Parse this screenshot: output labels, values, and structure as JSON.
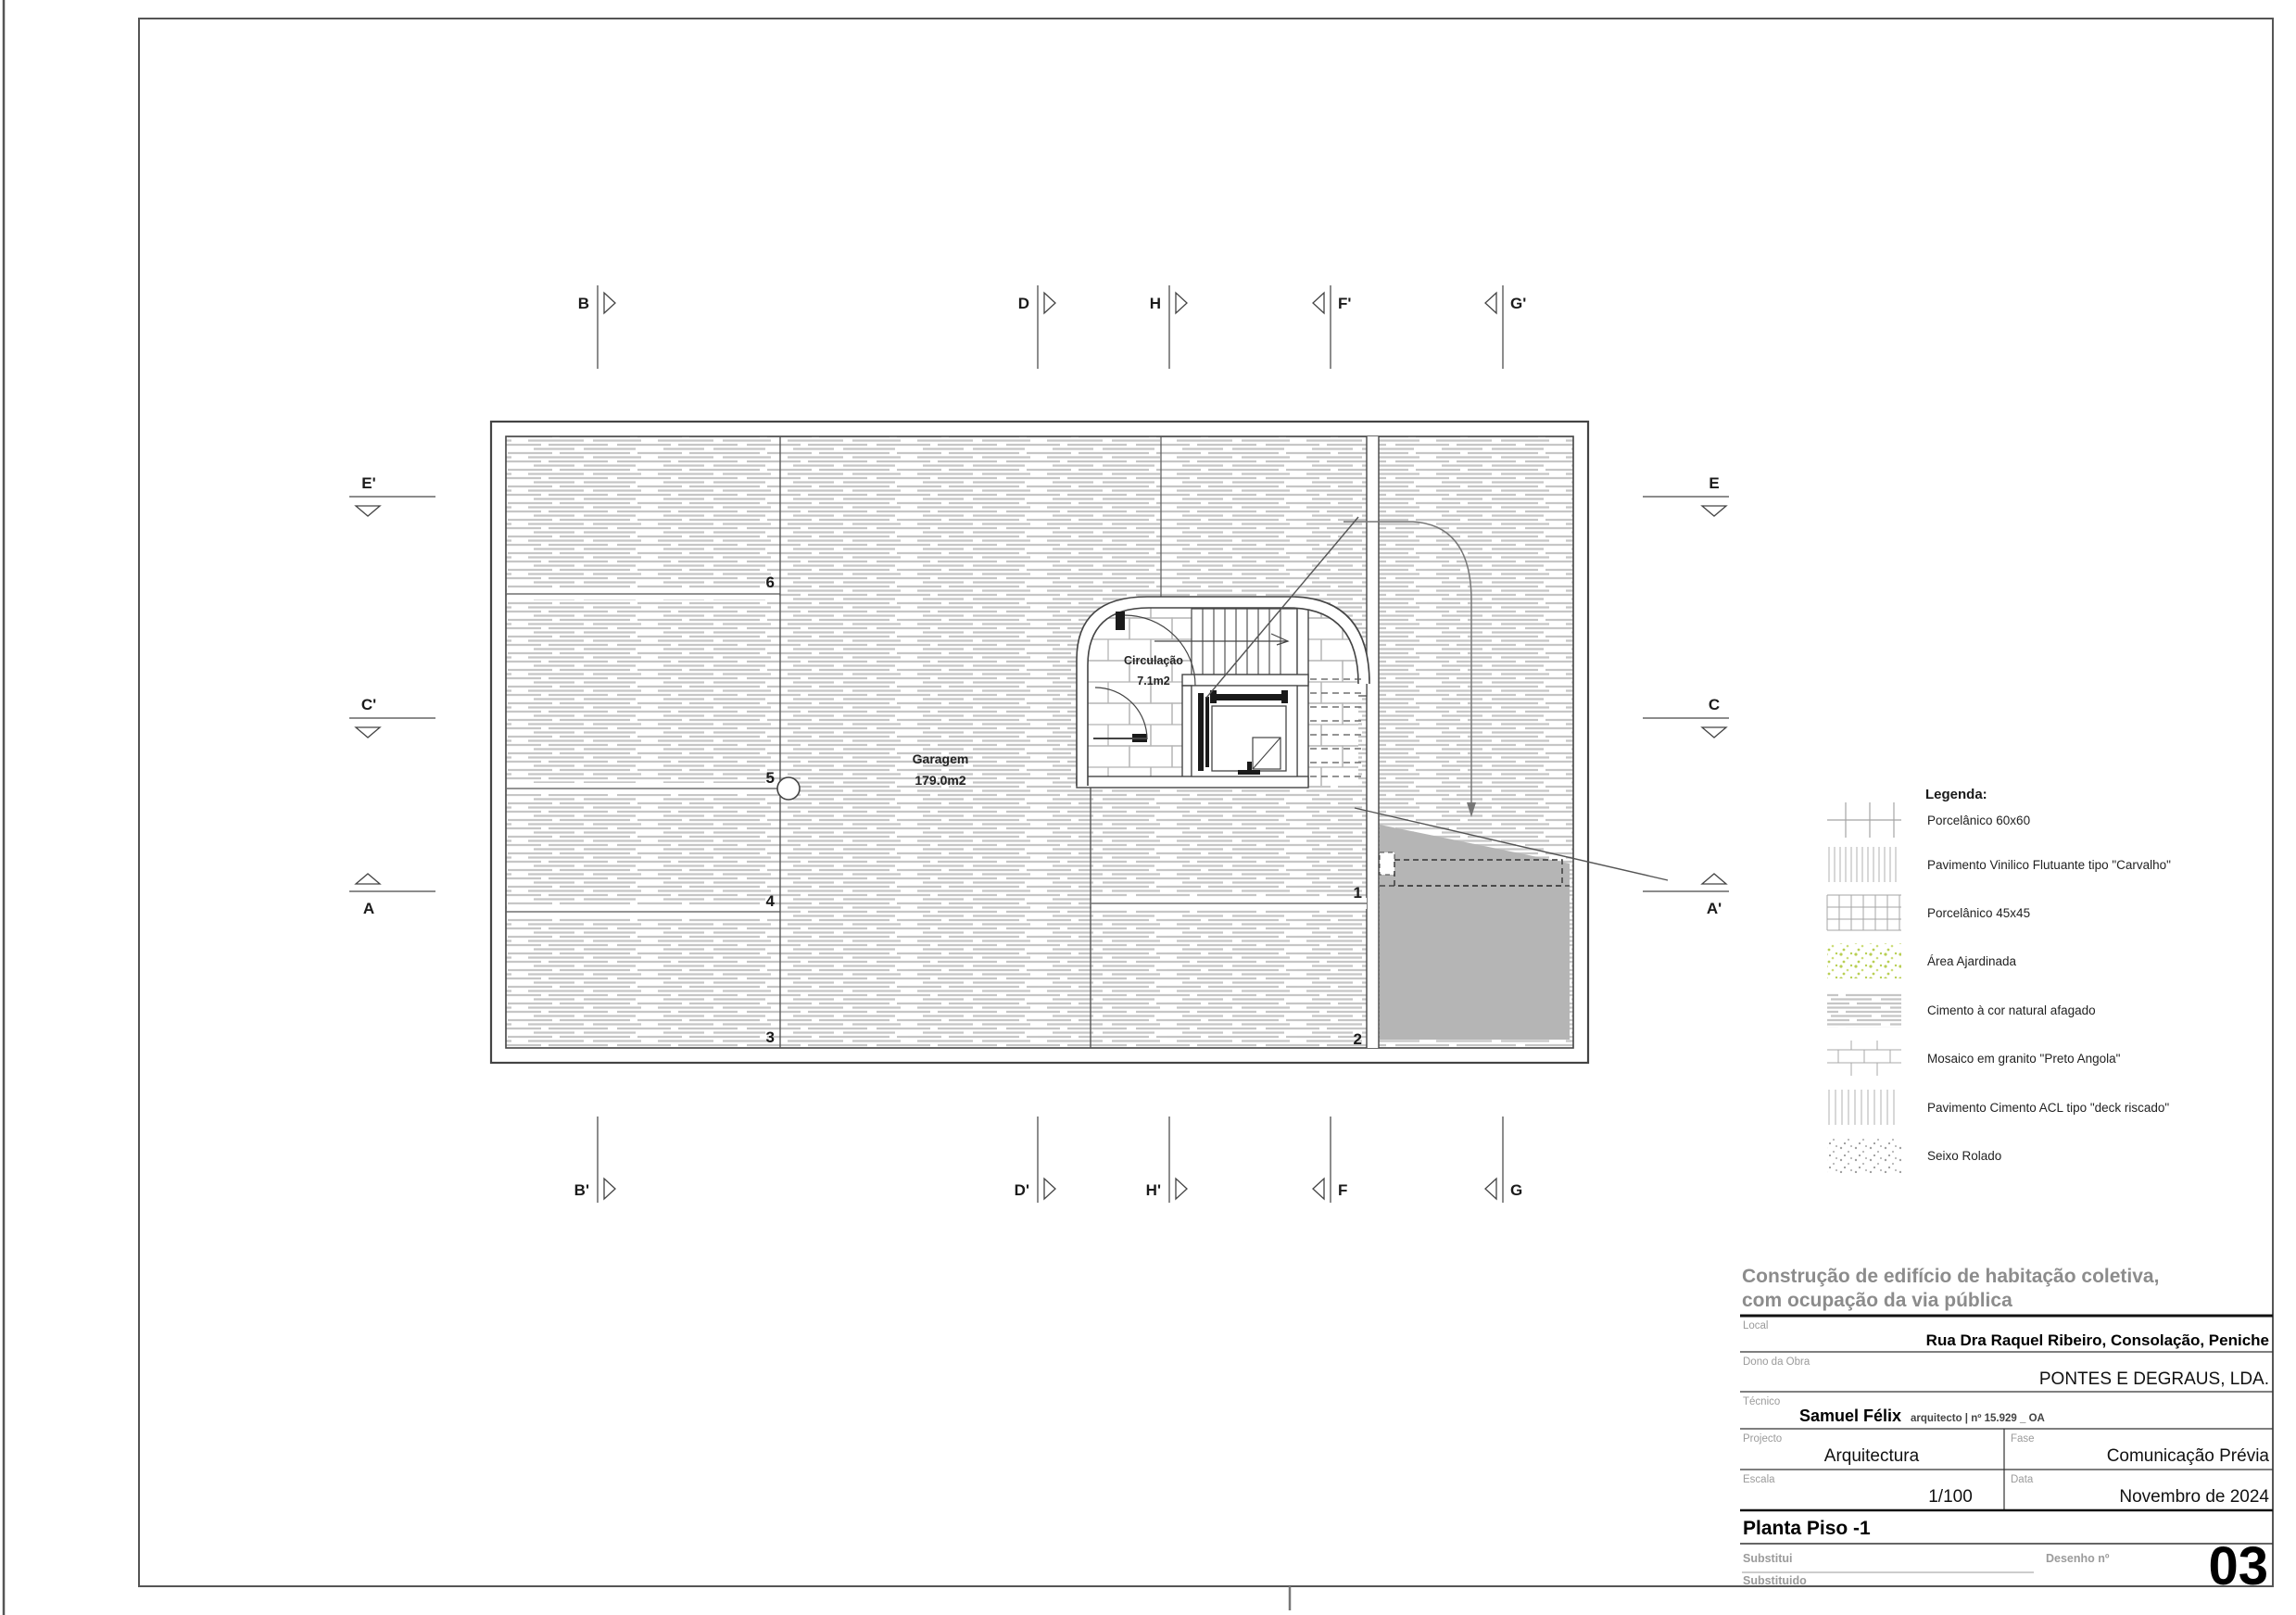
{
  "rooms": {
    "garagem": {
      "name": "Garagem",
      "area": "179.0m2"
    },
    "circulacao": {
      "name": "Circulação",
      "area": "7.1m2"
    }
  },
  "stalls": [
    "1",
    "2",
    "3",
    "4",
    "5",
    "6"
  ],
  "markers": {
    "top": [
      "B",
      "D",
      "H",
      "F'",
      "G'"
    ],
    "bottom": [
      "B'",
      "D'",
      "H'",
      "F",
      "G"
    ],
    "left": [
      "E'",
      "C'",
      "A"
    ],
    "right": [
      "E",
      "C",
      "A'"
    ]
  },
  "legend": {
    "title": "Legenda:",
    "items": [
      {
        "label": "Porcelânico 60x60",
        "pattern": "grid-60"
      },
      {
        "label": "Pavimento Vinilico Flutuante tipo \"Carvalho\"",
        "pattern": "vertical-lines-dense"
      },
      {
        "label": "Porcelânico 45x45",
        "pattern": "grid-45"
      },
      {
        "label": "Área Ajardinada",
        "pattern": "green-speckle"
      },
      {
        "label": "Cimento à cor natural afagado",
        "pattern": "cement-streaks"
      },
      {
        "label": "Mosaico em granito \"Preto Angola\"",
        "pattern": "granite-bond"
      },
      {
        "label": "Pavimento Cimento ACL tipo \"deck riscado\"",
        "pattern": "vertical-lines"
      },
      {
        "label": "Seixo Rolado",
        "pattern": "pebble-dots"
      }
    ]
  },
  "titleblock": {
    "project_title_line1": "Construção de edifício de habitação coletiva,",
    "project_title_line2": "com ocupação da via pública",
    "local_label": "Local",
    "local_value": "Rua Dra Raquel Ribeiro, Consolação, Peniche",
    "dono_label": "Dono da Obra",
    "dono_value": "PONTES E DEGRAUS, LDA.",
    "tecnico_label": "Técnico",
    "tecnico_name": "Samuel Félix",
    "tecnico_credentials": "arquitecto | nº 15.929 _ OA",
    "projecto_label": "Projecto",
    "projecto_value": "Arquitectura",
    "fase_label": "Fase",
    "fase_value": "Comunicação Prévia",
    "escala_label": "Escala",
    "escala_value": "1/100",
    "data_label": "Data",
    "data_value": "Novembro de 2024",
    "drawing_title": "Planta Piso -1",
    "substitui_label": "Substitui",
    "substituido_label": "Substituido",
    "desenho_label": "Desenho nº",
    "desenho_value": "03"
  },
  "colors": {
    "line": "#444444",
    "hatch": "#c6c6c6",
    "ramp_gray": "#b5b5b5",
    "green_speckle": "#b9cf54",
    "title_gray": "#8c8c8c"
  }
}
